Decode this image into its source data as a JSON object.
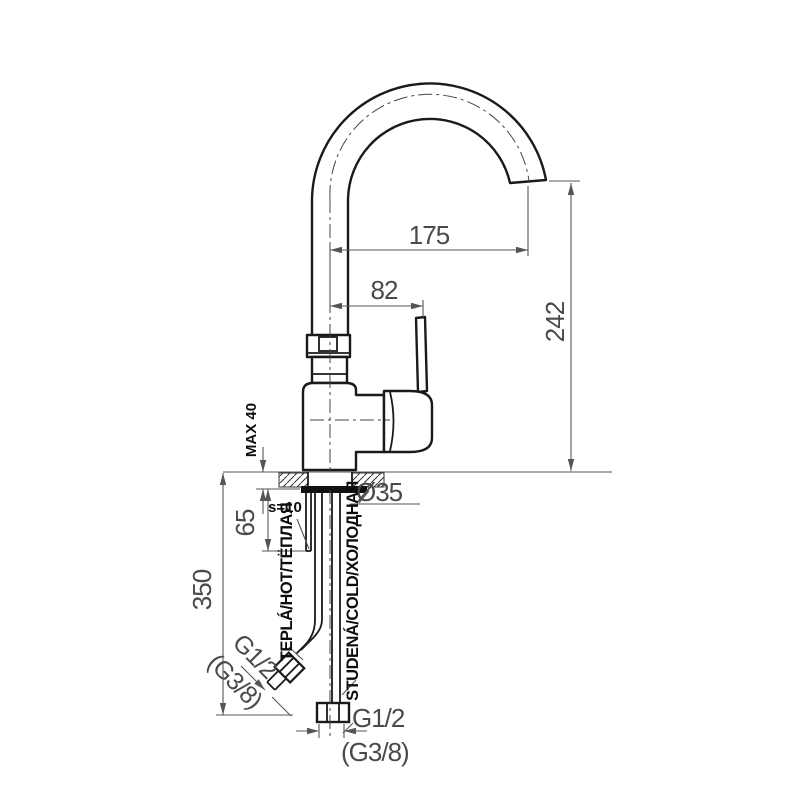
{
  "drawing": {
    "type": "technical-drawing",
    "subject": "single-lever kitchen faucet with high gooseneck spout, mounted through countertop, two supply hoses"
  },
  "dimensions": {
    "spout_reach": "175",
    "handle_offset": "82",
    "spout_height": "242",
    "max_counter_thickness": "MAX 40",
    "hole_diameter": "Ø35",
    "shank_size": "s=10",
    "shank_length": "65",
    "hose_length": "350"
  },
  "labels": {
    "warm_line": "TEPLÁ/HOT/ТЁПЛАЯ",
    "cold_line": "STUDENÁ/COLD/ХОЛОДНАЯ",
    "left_thread_primary": "G1/2",
    "left_thread_alt": "(G3/8)",
    "bottom_thread_primary": "G1/2",
    "bottom_thread_alt": "(G3/8)"
  },
  "colors": {
    "background": "#ffffff",
    "drawing_line": "#1a1a1a",
    "dimension_line": "#555555",
    "dimension_text": "#4a4a4a",
    "label_text": "#0d0d0d"
  }
}
